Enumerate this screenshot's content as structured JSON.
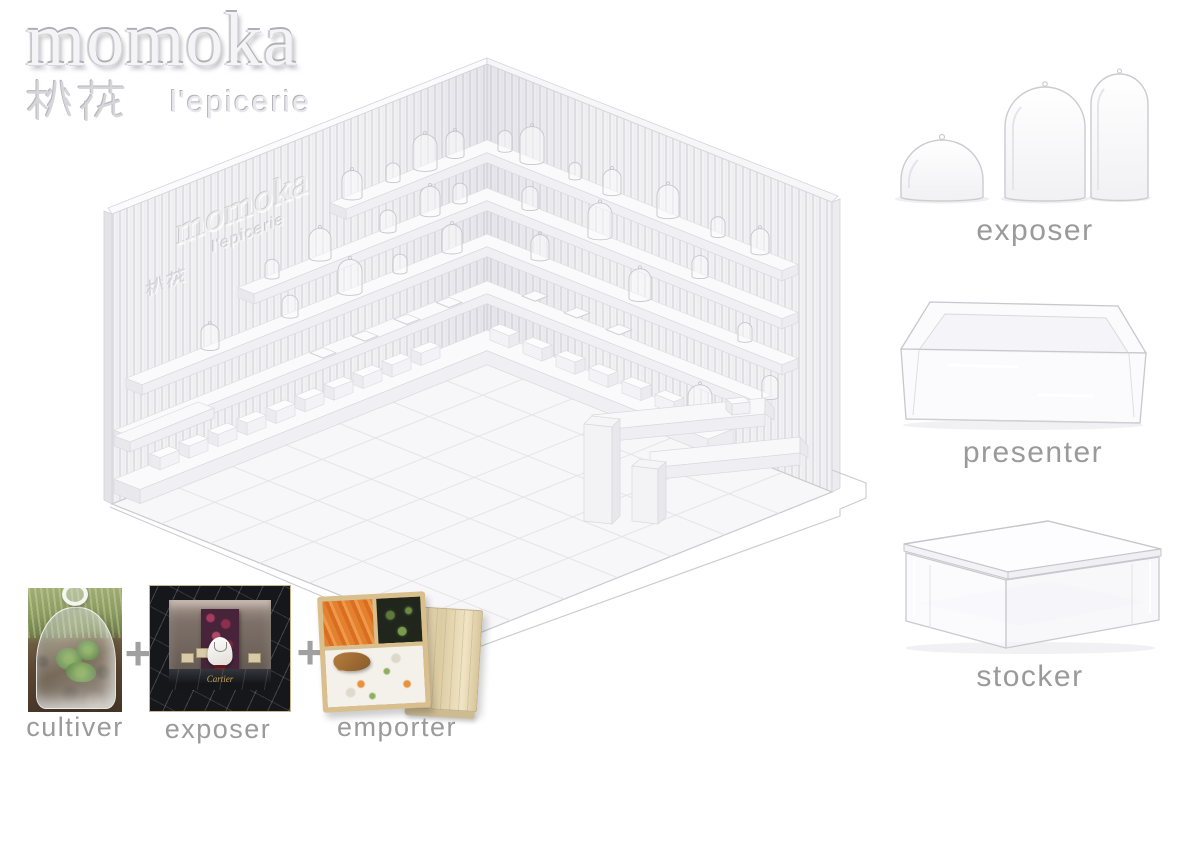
{
  "logo": {
    "title": "momoka",
    "cjk": "桃花",
    "subtitle": "l'epicerie"
  },
  "render": {
    "wall_logo": {
      "title": "momoka",
      "subtitle": "l'epicerie",
      "cjk": "桃花"
    }
  },
  "products": [
    {
      "id": "exposer",
      "label": "exposer",
      "icon": "glass-cloche-domes-icon"
    },
    {
      "id": "presenter",
      "label": "presenter",
      "icon": "acrylic-tray-icon"
    },
    {
      "id": "stocker",
      "label": "stocker",
      "icon": "acrylic-box-icon"
    }
  ],
  "concept": {
    "separator": "+",
    "items": [
      {
        "id": "cultiver",
        "label": "cultiver",
        "photo": "glass-cloche-over-seedlings"
      },
      {
        "id": "exposer",
        "label": "exposer",
        "photo": "jewelry-vitrine-display",
        "photo_text": "Cartier"
      },
      {
        "id": "emporter",
        "label": "emporter",
        "photo": "wooden-bento-box-with-lid"
      }
    ]
  },
  "colors": {
    "label_gray": "#9a9a9a",
    "emboss_light": "#f4f4f6",
    "render_wall": "#f2f2f5",
    "slat_line": "#dfdfe4",
    "floor": "#f7f7f9",
    "marble_black": "#15171b",
    "gold": "#c9a45c",
    "wood_light": "#e4d5ae",
    "accent_red": "#7e1f24"
  }
}
